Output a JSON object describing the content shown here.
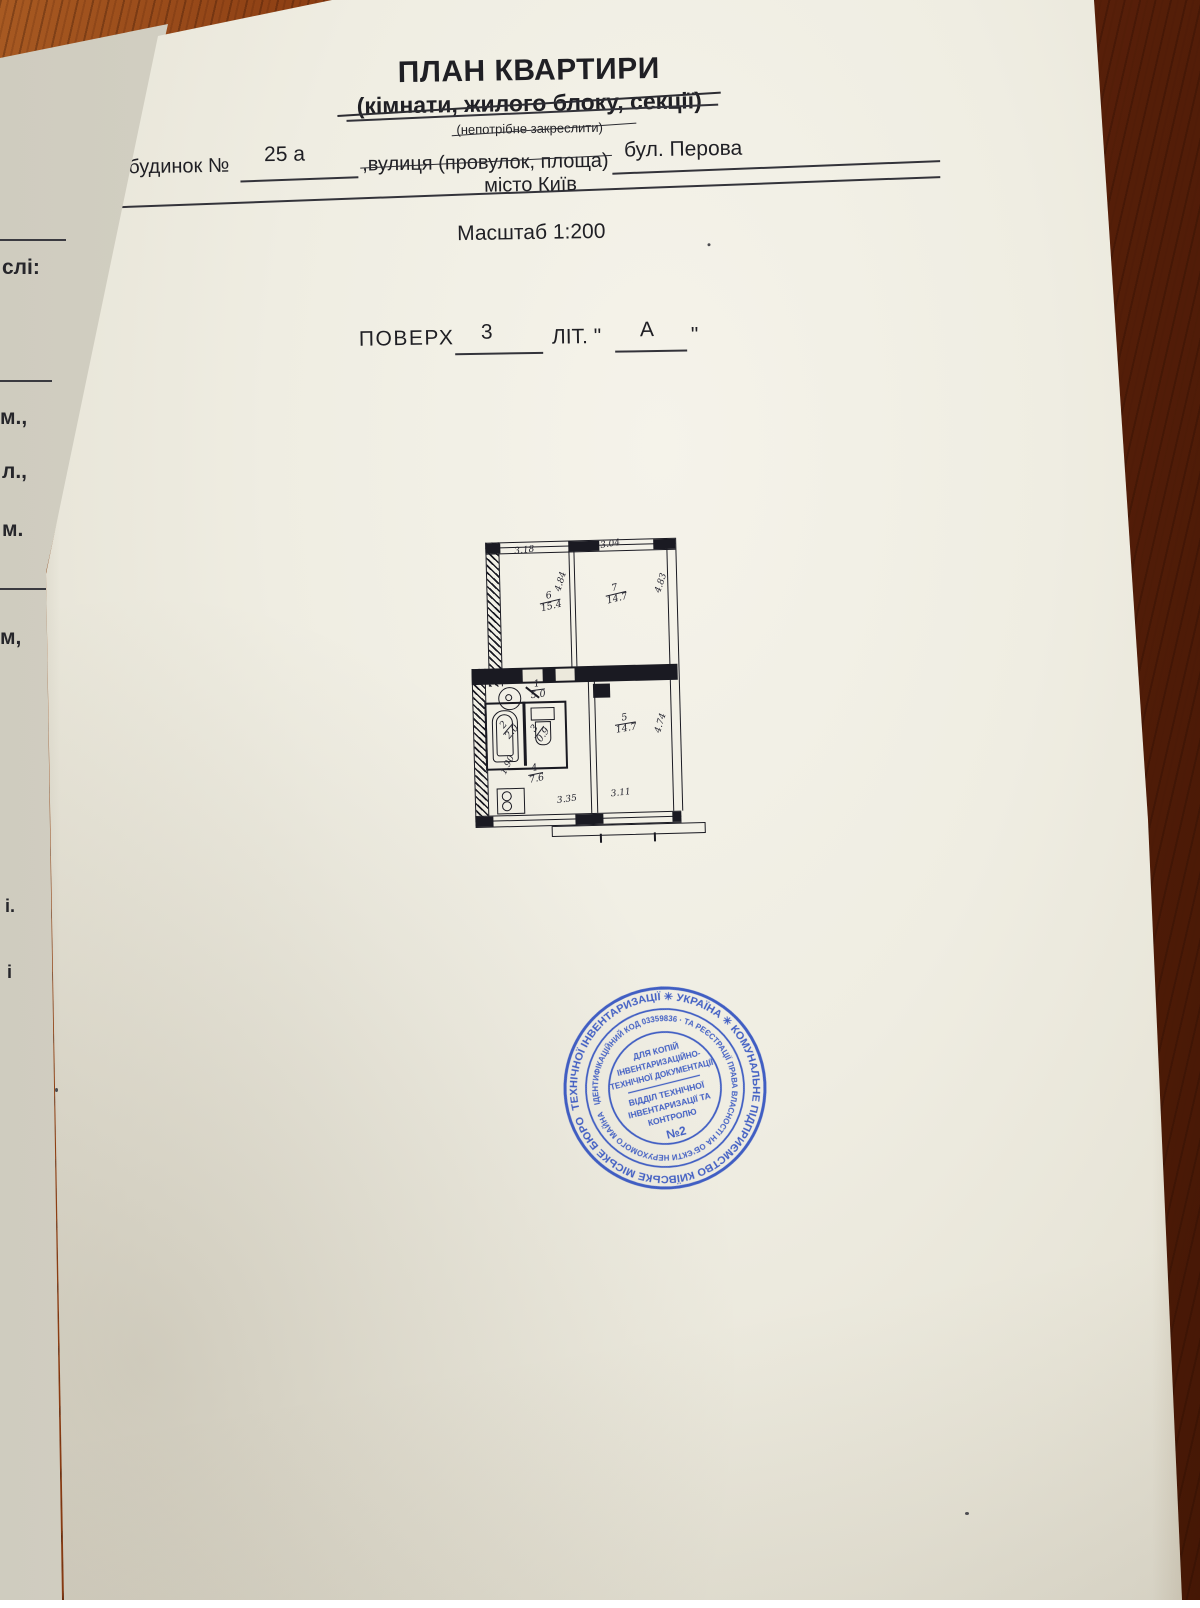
{
  "document": {
    "title": "ПЛАН КВАРТИРИ",
    "subtitle": "(кімнати, жилого блоку, секції)",
    "note": "(непотрібне закреслити)",
    "house_label": "будинок №",
    "house_number": "25 а",
    "street_label": ",вулиця (провулок, площа)",
    "street_value": "бул. Перова",
    "city": "місто Київ",
    "scale": "Масштаб 1:200",
    "floor_label": "ПОВЕРХ",
    "floor_value": "3",
    "liter_label": "ЛІТ. \"",
    "liter_value": "А",
    "liter_close": "\""
  },
  "plan": {
    "rooms": [
      {
        "num": "1",
        "area": "5.0"
      },
      {
        "num": "2",
        "area": "2.0"
      },
      {
        "num": "3",
        "area": "0.9"
      },
      {
        "num": "4",
        "area": "7.6"
      },
      {
        "num": "5",
        "area": "14.7"
      },
      {
        "num": "6",
        "area": "15.4"
      },
      {
        "num": "7",
        "area": "14.7"
      }
    ],
    "dims": {
      "room6_width": "3.18",
      "room7_width": "3.04",
      "room6_depth": "4.84",
      "room7_depth": "4.83",
      "kitchen_depth": "1.90",
      "room5_depth": "4.74",
      "kitchen_width": "3.35",
      "room5_width": "3.11"
    }
  },
  "stamp": {
    "outer_ring": "ТЕХНІЧНОЇ ІНВЕНТАРИЗАЦІЇ ✳ УКРАЇНА ✳ КОМУНАЛЬНЕ ПІДПРИЄМСТВО КИЇВСЬКЕ МІСЬКЕ БЮРО",
    "inner_ring": "ІДЕНТИФІКАЦІЙНИЙ КОД 03359836 · ТА РЕЄСТРАЦІЇ ПРАВА ВЛАСНОСТІ НА ОБ’ЄКТИ НЕРУХОМОГО МАЙНА",
    "center": [
      "ДЛЯ КОПІЙ",
      "ІНВЕНТАРИЗАЦІЙНО-",
      "ТЕХНІЧНОЇ ДОКУМЕНТАЦІЇ",
      "ВІДДІЛ ТЕХНІЧНОЇ",
      "ІНВЕНТАРИЗАЦІЇ ТА",
      "КОНТРОЛЮ",
      "№2"
    ],
    "color": "#2e4fc0"
  },
  "margin_fragments": [
    "слі:",
    "м.,",
    "л.,",
    "м.",
    "м,",
    "і.",
    "і"
  ]
}
